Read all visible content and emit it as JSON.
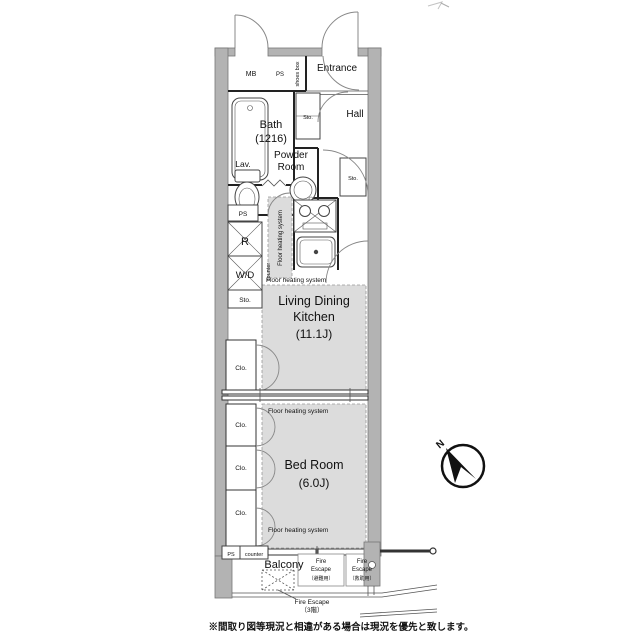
{
  "colors": {
    "wall": "#b3b3b3",
    "floor_heating": "#dcdcdc",
    "line": "#222222",
    "text": "#111111",
    "background": "#ffffff"
  },
  "plan": {
    "top": {
      "mb": "MB",
      "ps": "PS",
      "shoes_box": "shoes box",
      "entrance": "Entrance"
    },
    "bath": {
      "name": "Bath",
      "size": "(1216)"
    },
    "hall": {
      "name": "Hall",
      "sto": "Sto."
    },
    "powder": {
      "lav": "Lav.",
      "name_line1": "Powder",
      "name_line2": "Room",
      "sto": "Sto."
    },
    "utility": {
      "ps": "PS",
      "refrigerator": "R",
      "washer_dryer": "W/D",
      "counter": "counter",
      "sto": "Sto."
    },
    "kitchen": {
      "floor_heating_vertical": "Floor heating system"
    },
    "ldk": {
      "floor_heating": "Floor heating system",
      "name_line1": "Living Dining",
      "name_line2": "Kitchen",
      "size": "(11.1J)",
      "closet": "Clo."
    },
    "bedroom": {
      "floor_heating_top": "Floor heating system",
      "name": "Bed Room",
      "size": "(6.0J)",
      "closet1": "Clo.",
      "closet2": "Clo.",
      "closet3": "Clo.",
      "floor_heating_bottom": "Floor heating system"
    },
    "shaft": {
      "ps": "PS",
      "counter": "counter"
    },
    "balcony": {
      "name": "Balcony",
      "fire_escape_left": {
        "line1": "Fire",
        "line2": "Escape",
        "line3": "（避難用）"
      },
      "fire_escape_right": {
        "line1": "Fire",
        "line2": "Escape",
        "line3": "（救助用）"
      },
      "fire_escape_hatch": {
        "line1": "Fire Escape",
        "line2": "（3階）"
      }
    },
    "compass": {
      "north": "N"
    },
    "footer": {
      "disclaimer": "※間取り図等現況と相違がある場合は現況を優先と致します。"
    }
  }
}
